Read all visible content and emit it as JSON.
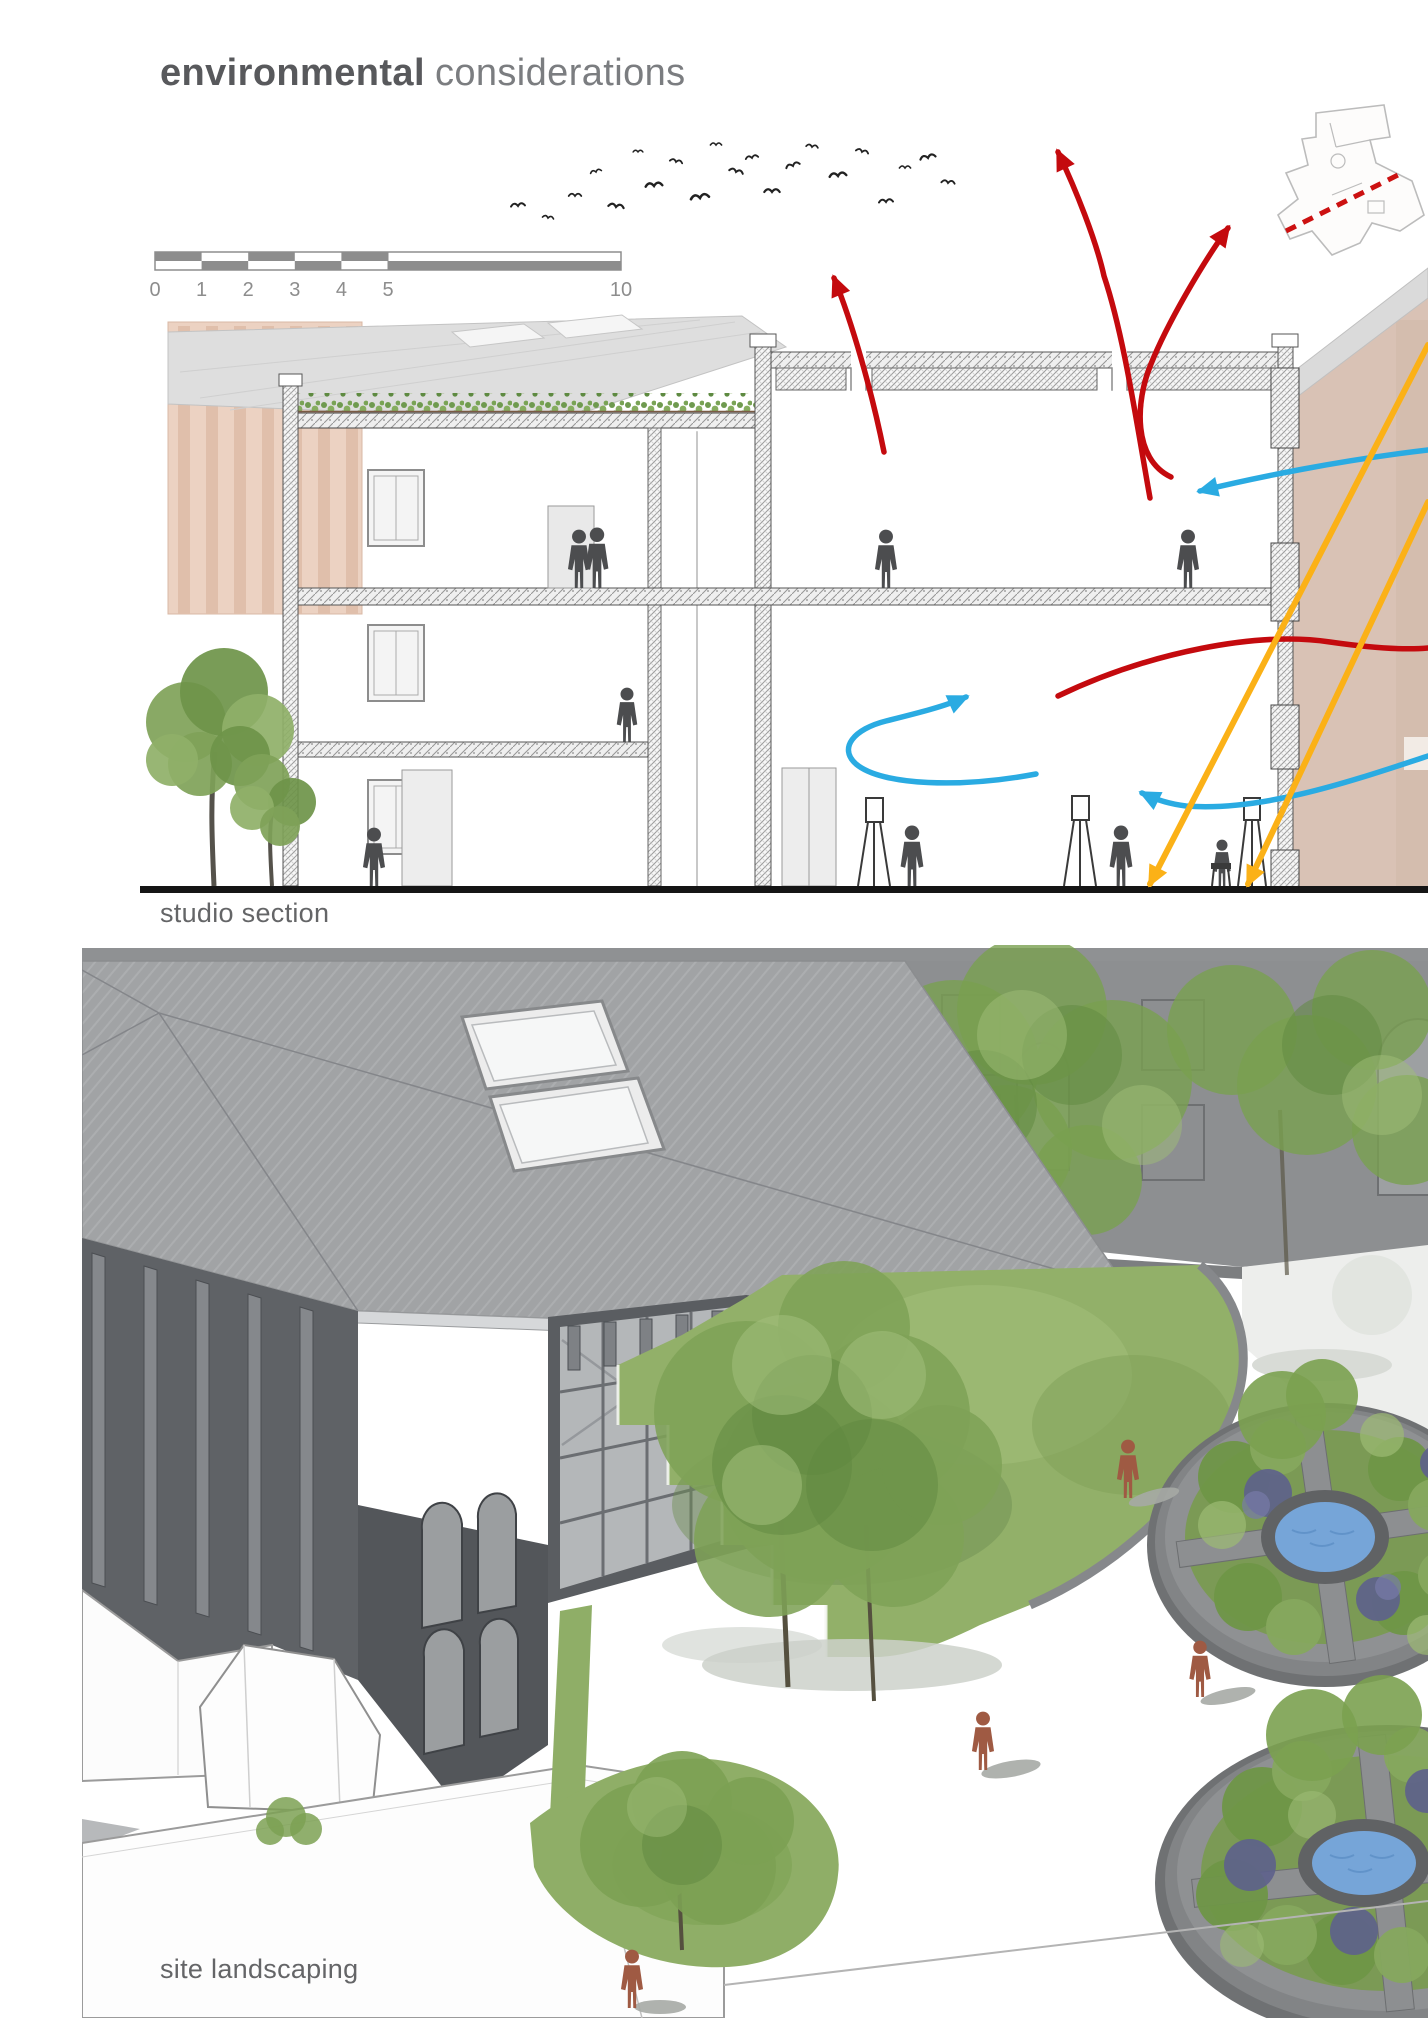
{
  "header": {
    "title_bold": "environmental",
    "title_light": "considerations"
  },
  "section_figure": {
    "caption": "studio section",
    "scale_labels": [
      "0",
      "1",
      "2",
      "3",
      "4",
      "5",
      "10"
    ]
  },
  "landscape_figure": {
    "caption": "site landscaping"
  },
  "colors": {
    "warm_air_arrow": "#c40a0e",
    "cool_air_arrow": "#2aabe2",
    "sunlight_arrow": "#fbb117",
    "section_cut_line": "#cc1111",
    "scale_bar": "#8d8d8d",
    "green_roof": "#7da25b",
    "adjacent_building": "#d9c2b5",
    "lawn": "#92b069",
    "pond_water": "#76a5d8",
    "figure_people_render": "#9f5a43"
  }
}
